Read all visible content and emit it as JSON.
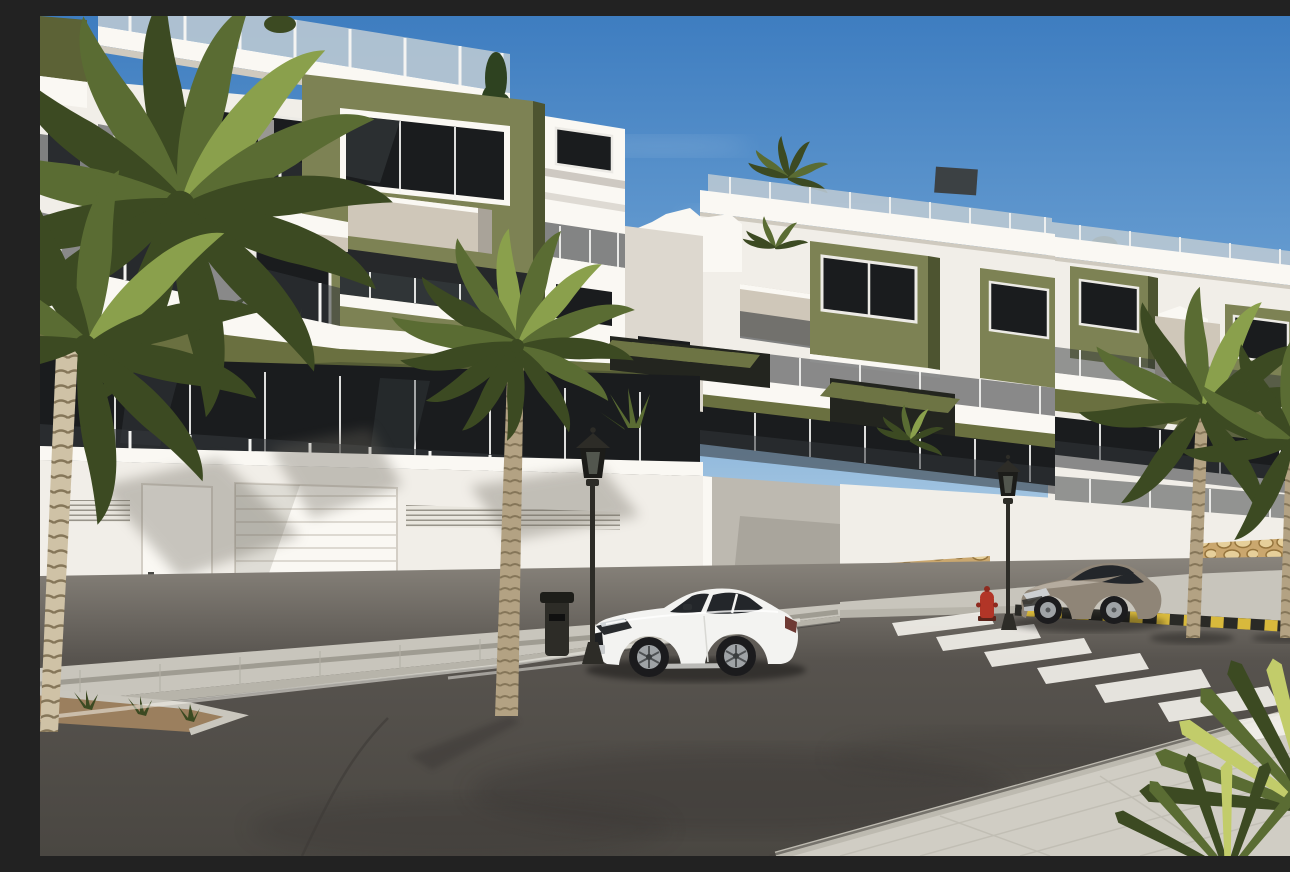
{
  "scene": {
    "type": "photorealistic CGI real-estate render",
    "description": "Sunny 3D architectural rendering of a new-build white apartment complex with olive-green accent walls, tinted-glass balconies, stone-clad perimeter walls and white garage doors; palm trees line a clean asphalt street with a zebra crosswalk, a yellow-and-black striped kerb, classic lantern street lamps, a red fire hydrant, and a white coupe and a grey coupe parked at the kerb under a clear blue sky.",
    "setting": "residential street, daytime, clear sky",
    "text_visible": "none"
  },
  "sky": {
    "top": "#3e7dc0",
    "mid": "#6fa3d4",
    "horizon": "#dcebf3",
    "clouds": "thin wisps right of centre"
  },
  "palette": {
    "wall_white": "#f1eee8",
    "wall_bright": "#faf8f3",
    "wall_shade": "#ddd8cf",
    "wall_cream": "#cfc7b9",
    "wall_dark": "#a9a399",
    "olive": "#7d8254",
    "olive_dark": "#4d5430",
    "olive_band": "#6a7040",
    "glass_dark": "#1a1c1e",
    "glass_mid": "#3c4144",
    "rail_glass": "#33373a",
    "roof_rail_glass": "#b9c8d3",
    "post": "#f4f4f2",
    "frame": "#eceae5",
    "stone_base": "#caa76e",
    "stone_dark": "#96753d",
    "stone_light": "#e6cf9a",
    "sidewalk": "#c8c5bc",
    "curb_face": "#b7b4aa",
    "road_near": "#4a4742",
    "road_mid": "#57534e",
    "road_far": "#8a857d",
    "mark_white": "#f2f0ea",
    "stripe_yellow": "#d8b93c",
    "stripe_black": "#2a2a26",
    "car_white": "#f3f3f1",
    "car_glass": "#23262a",
    "wheel_silver": "#9fa3a6",
    "car_gray": "#8f8577",
    "car_gray_light": "#b5ac9f",
    "metal": "#2d2c27",
    "hydrant_red": "#b23527",
    "palm_dark": "#3c4a22",
    "palm_mid": "#5a6c33",
    "palm_light": "#8aa04c",
    "palm_yellow": "#c2cc6a",
    "trunk": "#b3a283",
    "trunk_dark": "#857659",
    "trunk_light": "#cfc2a6"
  },
  "objects": {
    "buildings": [
      {
        "name": "left apartment block",
        "floors": 3,
        "features": [
          "rooftop glass railing",
          "olive-green feature wall",
          "recessed balconies",
          "tinted glass balustrades",
          "stone-clad base",
          "white sectional garage door",
          "pedestrian door",
          "ventilation louvres"
        ]
      },
      {
        "name": "centre apartment block",
        "floors": 3,
        "features": [
          "roof-terrace planting",
          "olive accent boxes",
          "slatted pergolas",
          "driveway ramp opening"
        ]
      },
      {
        "name": "right apartment row",
        "floors": 3,
        "features": [
          "receding perspective",
          "green accent boxes",
          "roof terraces",
          "stone-clad street wall"
        ]
      }
    ],
    "vehicles": [
      {
        "name": "white coupe",
        "color_hex": "#f3f3f1",
        "position": "parked centre-left, facing left"
      },
      {
        "name": "grey coupe",
        "color_hex": "#8f8577",
        "position": "parked right of crosswalk, facing left"
      }
    ],
    "street": {
      "road": "dark asphalt with worn patches",
      "crosswalk_stripes": 7,
      "curb_marking": "yellow-black hazard stripes",
      "edge_lines": "faint white",
      "sidewalk": "light concrete pavers",
      "planter": "gravel bed with grass tufts, bottom left"
    },
    "furniture": [
      {
        "name": "lantern street lamp",
        "count": 3
      },
      {
        "name": "litter bin",
        "count": 1
      },
      {
        "name": "fire hydrant",
        "count": 1,
        "color_hex": "#b23527"
      }
    ],
    "vegetation": {
      "large_palm_top_left": 1,
      "street_palm_centre": 1,
      "street_palms_right": 2,
      "foreground_fan_palm_bottom_right": true,
      "roof_plants": [
        "conifer",
        "shrubs",
        "potted palms"
      ],
      "terrace_plants": [
        "strelitzia",
        "agave",
        "fan palm"
      ]
    }
  }
}
